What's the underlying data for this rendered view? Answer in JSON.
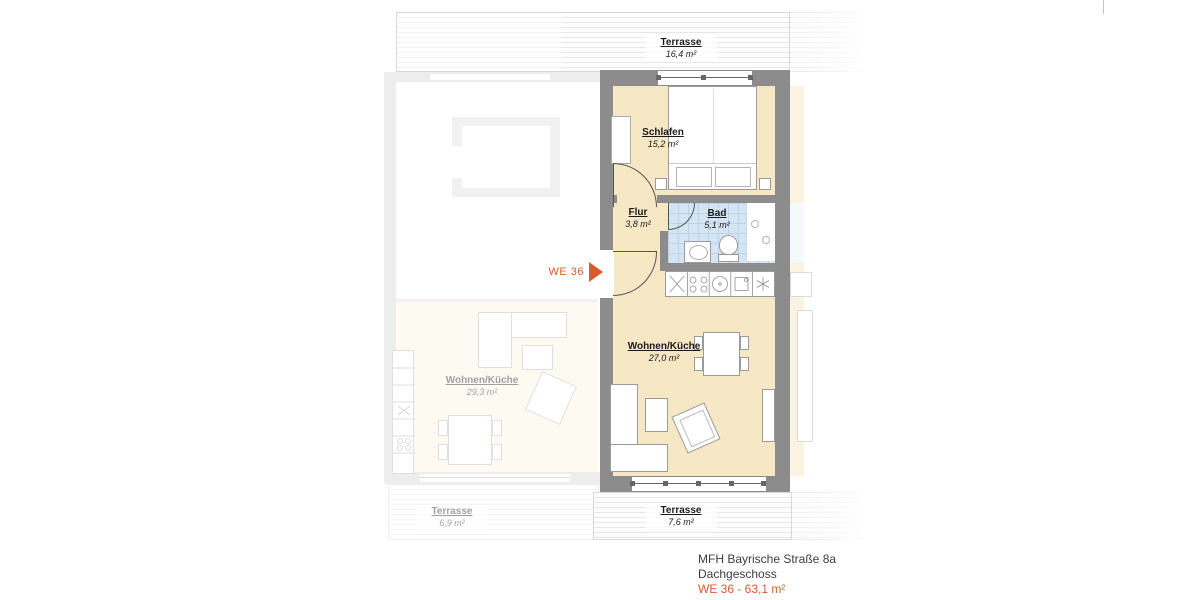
{
  "colors": {
    "accent": "#d95b2f",
    "floor_beige": "#f6e8c5",
    "bathroom_blue": "#d6e5f4",
    "wall_gray": "#8c8c8c"
  },
  "plan": {
    "unit_marker": "WE 36",
    "rooms": {
      "terrasse_top": {
        "name": "Terrasse",
        "area": "16,4 m²"
      },
      "schlafen": {
        "name": "Schlafen",
        "area": "15,2 m²"
      },
      "flur": {
        "name": "Flur",
        "area": "3,8 m²"
      },
      "bad": {
        "name": "Bad",
        "area": "5,1 m²"
      },
      "wohnen_kueche": {
        "name": "Wohnen/Küche",
        "area": "27,0 m²"
      },
      "terrasse_bottom": {
        "name": "Terrasse",
        "area": "7,6 m²"
      }
    },
    "neighbor_left": {
      "wohnen_kueche": {
        "name": "Wohnen/Küche",
        "area": "29,3 m²"
      },
      "terrasse": {
        "name": "Terrasse",
        "area": "6,9 m²"
      }
    }
  },
  "title_block": {
    "building": "MFH Bayrische Straße 8a",
    "floor": "Dachgeschoss",
    "unit": "WE 36 - 63,1 m²"
  }
}
